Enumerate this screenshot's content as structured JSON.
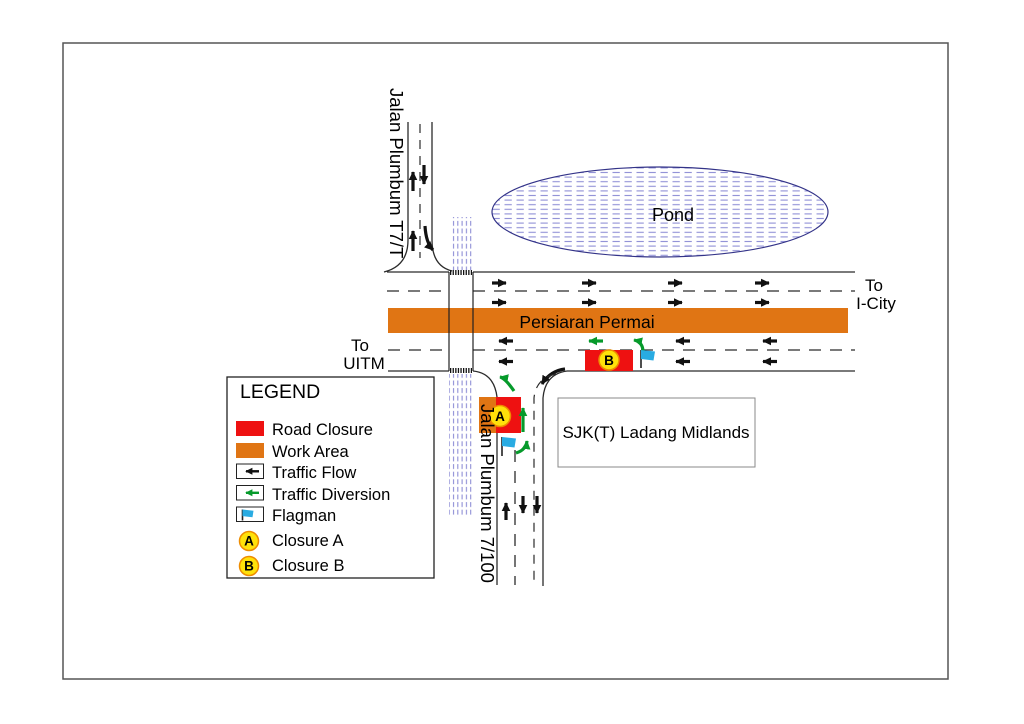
{
  "colors": {
    "road_closure_red": "#EE1111",
    "work_area_orange": "#E07514",
    "traffic_flow_black": "#111111",
    "traffic_diversion_green": "#069A2B",
    "flagman_blue": "#29ABE2",
    "closure_badge_yellow": "#FFE10A",
    "closure_badge_ring_orange": "#EE8C00",
    "closure_badge_letter_red": "#E03000",
    "hatch_blue": "#8F8FD6",
    "pond_outline_navy": "#333388"
  },
  "map": {
    "pond_label": "Pond",
    "main_road_label": "Persiaran Permai",
    "north_road_label": "Jalan Plumbum T7/T",
    "south_road_label": "Jalan Plumbum 7/100",
    "dest_east": {
      "line1": "To",
      "line2": "I-City"
    },
    "dest_west": {
      "line1": "To",
      "line2": "UITM"
    },
    "school_label": "SJK(T) Ladang Midlands",
    "closure_a_letter": "A",
    "closure_b_letter": "B"
  },
  "legend": {
    "title": "LEGEND",
    "items": [
      {
        "key": "road-closure",
        "label": "Road Closure"
      },
      {
        "key": "work-area",
        "label": "Work Area"
      },
      {
        "key": "traffic-flow",
        "label": "Traffic Flow"
      },
      {
        "key": "traffic-diversion",
        "label": "Traffic Diversion"
      },
      {
        "key": "flagman",
        "label": "Flagman"
      },
      {
        "key": "closure-a",
        "label": "Closure A",
        "badge": "A"
      },
      {
        "key": "closure-b",
        "label": "Closure B",
        "badge": "B"
      }
    ]
  }
}
